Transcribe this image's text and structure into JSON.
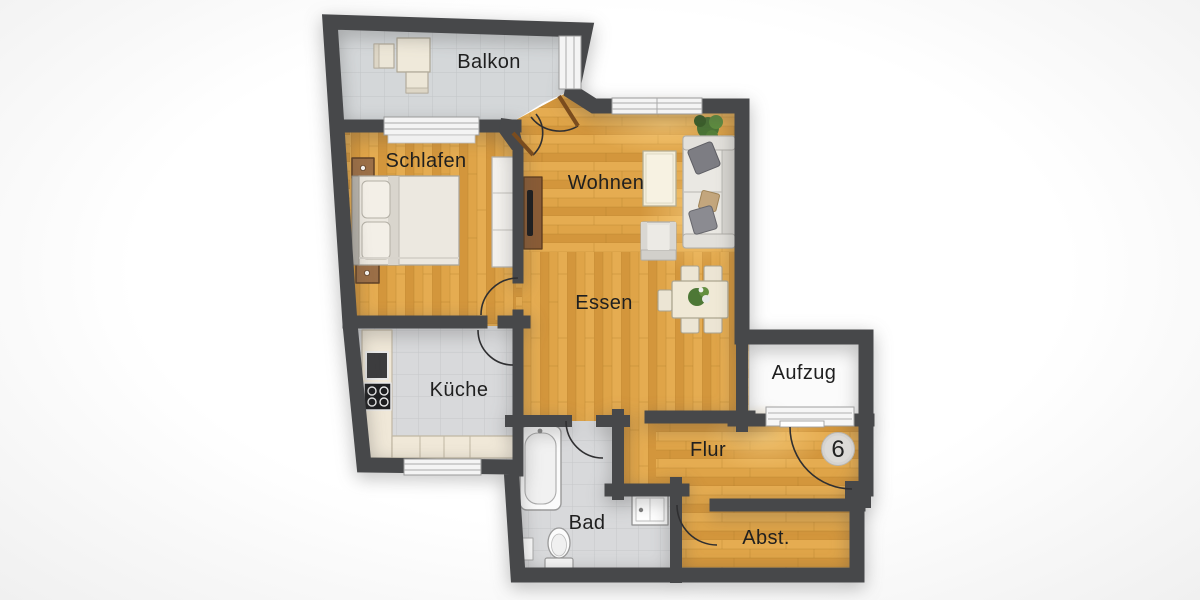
{
  "plan": {
    "unit_number": "6",
    "rooms": {
      "balkon": "Balkon",
      "schlafen": "Schlafen",
      "wohnen": "Wohnen",
      "essen": "Essen",
      "kueche": "Küche",
      "aufzug": "Aufzug",
      "flur": "Flur",
      "bad": "Bad",
      "abstellraum": "Abst."
    },
    "colors": {
      "wall": "#47484a",
      "wood": "#e0a74b",
      "tile": "#d8d9db",
      "balcony_tile": "#d4d7d9",
      "glow": "#ffd98c"
    }
  }
}
